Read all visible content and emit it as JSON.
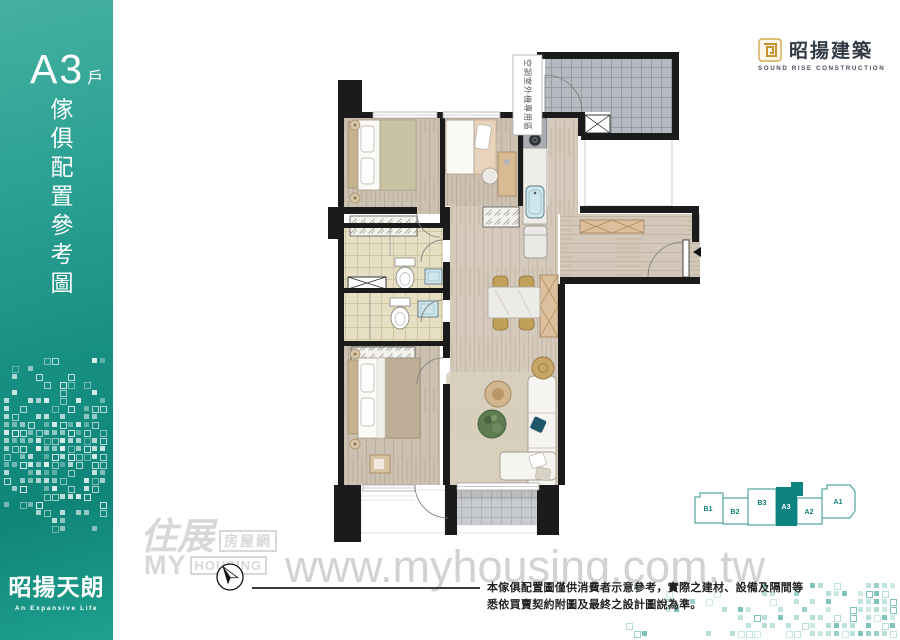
{
  "sidebar": {
    "unit": "A3",
    "unit_suffix": "戶",
    "vertical_title": "傢俱配置參考圖",
    "project_name": "昭揚天朗",
    "project_tagline": "An Expansive Life"
  },
  "builder": {
    "name": "昭揚建築",
    "subtitle": "SOUND RISE CONSTRUCTION"
  },
  "plan": {
    "ac_label": "空調室外機專用區"
  },
  "keyplan": {
    "units": [
      {
        "id": "B1",
        "active": false
      },
      {
        "id": "B2",
        "active": false
      },
      {
        "id": "B3",
        "active": false
      },
      {
        "id": "A3",
        "active": true
      },
      {
        "id": "A2",
        "active": false
      },
      {
        "id": "A1",
        "active": false
      }
    ]
  },
  "watermark": {
    "script": "住展",
    "boxed": "房屋網",
    "my": "MY",
    "housing": "HOUSING",
    "url": "www.myhousing.com.tw"
  },
  "disclaimer": {
    "line1": "本傢俱配置圖僅供消費者示意參考，實際之建材、設備及隔間等",
    "line2": "悉依買賣契約附圖及最終之設計圖說為準。"
  },
  "colors": {
    "accent_teal": "#178f83",
    "keyplan_teal": "#0e8280",
    "logo_gold": "#c9922f",
    "watermark_gray": "#d2d2d2",
    "wall_black": "#1b1b1b"
  }
}
